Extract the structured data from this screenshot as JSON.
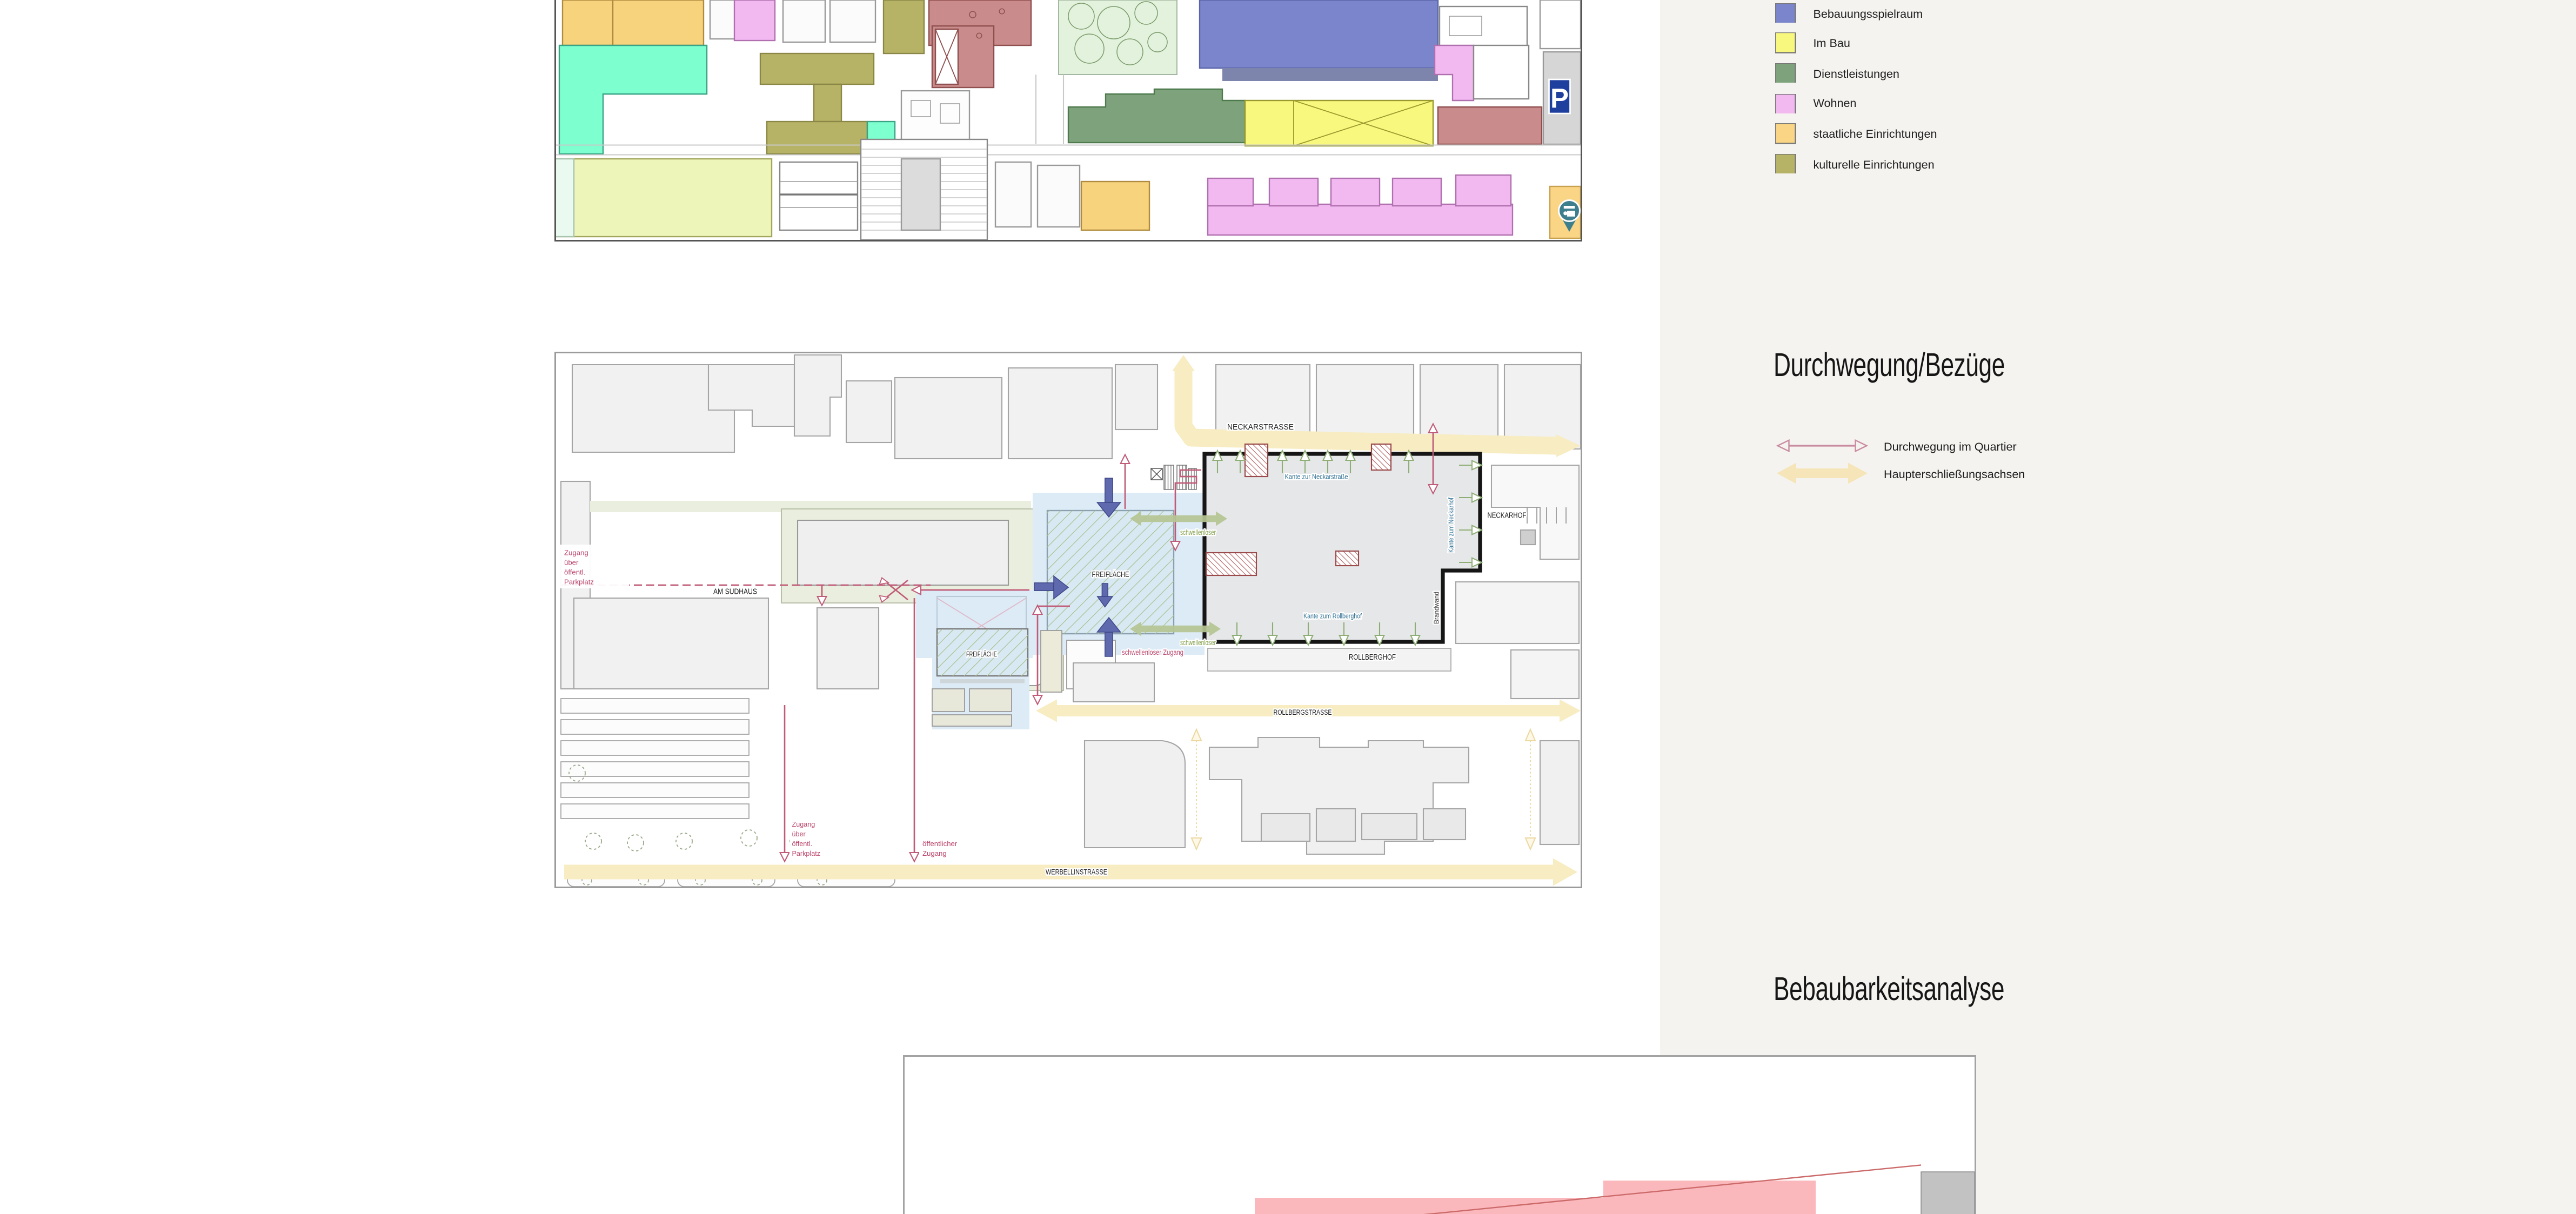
{
  "colors": {
    "page_background": "#ffffff",
    "panel_background": "#f5f3f0",
    "route_red": "#c05c78",
    "axis_yellow": "#f7ecc2",
    "barrier_free_green": "#b6c693",
    "flow_purple": "#5f69ae",
    "site_gray": "#e6e7e9",
    "freiflaeche_blue": "#dcebf6",
    "analysis_pink": "#fbb8bc",
    "analysis_gray": "#c2c2c2"
  },
  "legend_landuse": {
    "items": [
      {
        "label": "Bebauungsspielraum",
        "color": "#7b85cb"
      },
      {
        "label": "Im Bau",
        "color": "#f8f87e"
      },
      {
        "label": "Dienstleistungen",
        "color": "#7ea37c"
      },
      {
        "label": "Wohnen",
        "color": "#f2b9f1"
      },
      {
        "label": "staatliche Einrichtungen",
        "color": "#f9d585"
      },
      {
        "label": "kulturelle Einrichtungen",
        "color": "#b7b366"
      }
    ]
  },
  "section_durchwegung": {
    "title": "Durchwegung/Bezüge",
    "legend": [
      {
        "label": "Durchwegung im Quartier"
      },
      {
        "label": "Haupterschließungsachsen"
      }
    ]
  },
  "section_bebaubarkeit": {
    "title": "Bebaubarkeitsanalyse"
  },
  "map_durchwegung": {
    "streets": {
      "neckarstrasse": "NECKARSTRASSE",
      "rollbergstrasse": "ROLLBERGSTRASSE",
      "werbellinstrasse": "WERBELLINSTRASSE",
      "am_sudhaus": "AM SUDHAUS"
    },
    "places": {
      "neckarhof": "NECKARHOF",
      "rollberghof": "ROLLBERGHOF",
      "freiflaeche": "FREIFLÄCHE"
    },
    "edges": {
      "neckarstrasse": "Kante zur Neckarstraße",
      "neckarhof": "Kante zum Neckarhof",
      "rollberghof": "Kante zum Rollberghof",
      "brandwand": "Brandwand"
    },
    "access": {
      "zugang_parkplatz_lines": [
        "Zugang",
        "über",
        "öffentl.",
        "Parkplatz"
      ],
      "oeffentlicher_zugang_lines": [
        "öffentlicher",
        "Zugang"
      ],
      "schwellenlos": "schwellenloser",
      "schwellenloser_zugang": "schwellenloser Zugang"
    }
  },
  "map_nutzung": {
    "parking_sign": "P"
  }
}
